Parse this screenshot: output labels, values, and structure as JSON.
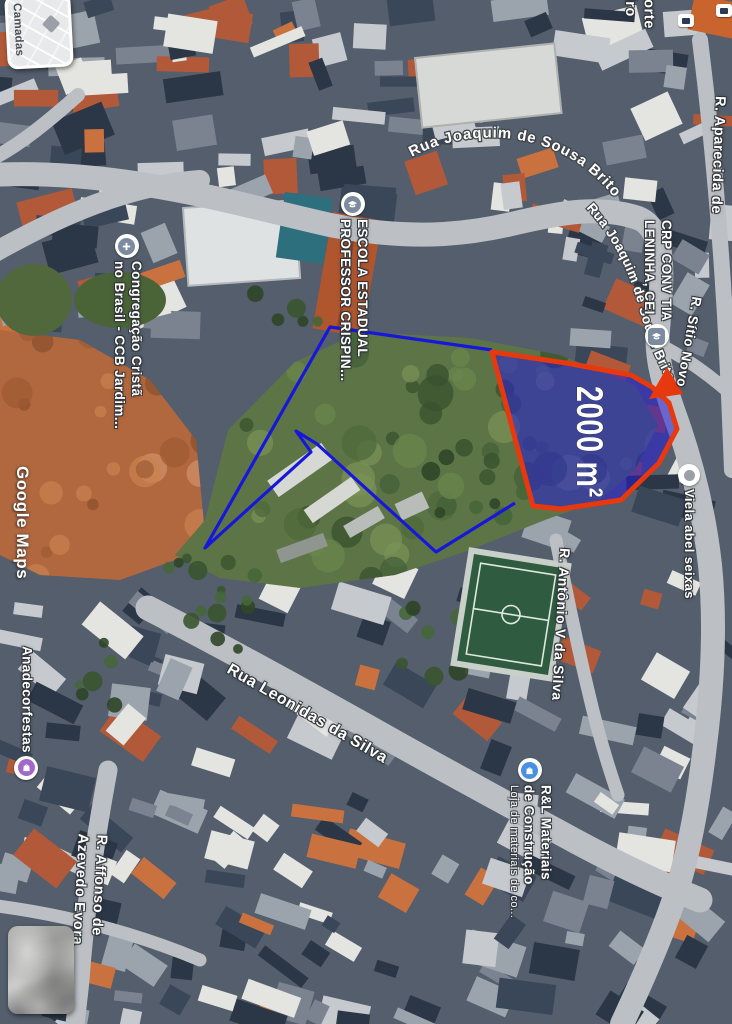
{
  "watermark": "Google Maps",
  "layers_widget": {
    "label": "Camadas"
  },
  "annotation": {
    "area_label": "2000 m²"
  },
  "streets": {
    "joaquim_top": "Rua Joaquim de Sousa Brito",
    "joaquim_right": "Rua Joaquim de Sousa Brito",
    "aparecida": "R. Aparecida de",
    "sitio_novo": "R. Sítio Novo",
    "leonidas": "Rua Leonidas da Silva",
    "antonio": "R. Antônio V da Silva",
    "viela_abel": "Viela abel seixas",
    "affonso_l1": "R. Affonso de",
    "affonso_l2": "Azevedo Evora",
    "norte_l1": "Norte",
    "norte_l2": "eiro"
  },
  "pois": {
    "escola": {
      "l1": "ESCOLA ESTADUAL",
      "l2": "PROFESSOR CRISPIN..."
    },
    "ccb": {
      "l1": "Congregação Cristã",
      "l2": "no Brasil - CCB Jardim..."
    },
    "cei": {
      "l1": "CRP CONV TIA",
      "l2": "LENINHA, CEI"
    },
    "anadecor": {
      "l1": "Anadecorfestas"
    },
    "rl": {
      "l1": "R&L Materiais",
      "l2": "de Construção",
      "subtitle": "Loja de materiais de co..."
    }
  },
  "colors": {
    "parcel_fill": "rgba(36,28,214,0.55)",
    "parcel_stroke": "#e8380d",
    "boundary": "#1717dc",
    "poi_slate": "#7d8ba1",
    "shopping_purple": "#a168c9",
    "shopping_blue": "#4a90e2"
  }
}
